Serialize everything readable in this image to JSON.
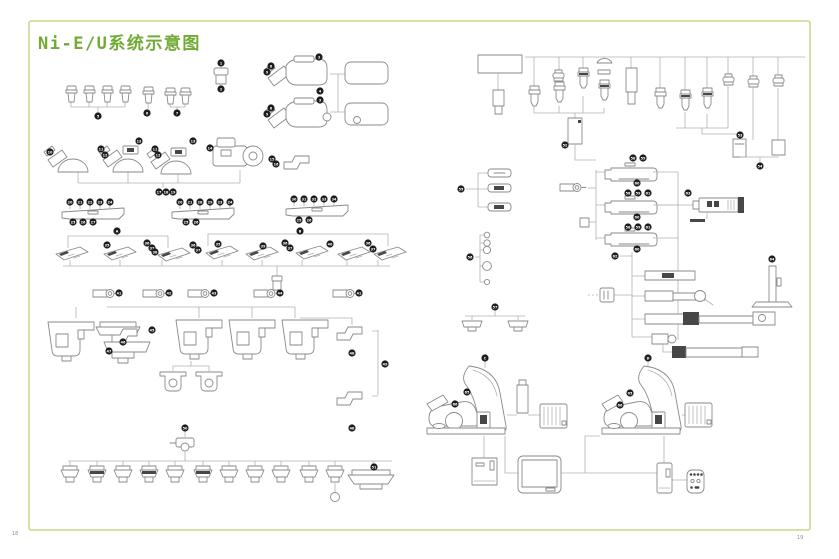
{
  "page": {
    "title": "Ni-E/U系统示意图",
    "page_number_left": "18",
    "page_number_right": "19"
  },
  "colors": {
    "title_green": "#72ab34",
    "border_green": "#cdde9d",
    "line_gray": "#b3b3b3",
    "part_gray": "#8a8a8a",
    "badge_black": "#1d1d1d"
  },
  "diagram": {
    "type": "exploded-system-diagram",
    "subject": "Nikon Ni-E/U upright microscope system configuration",
    "groups": [
      "eyepieces",
      "camera-heads",
      "observation-heads",
      "nosepiece-bars",
      "objective-turrets",
      "analyzer-sliders",
      "stages",
      "stage-clamps",
      "condensers",
      "objectives-tree",
      "filter-trays",
      "filter-circles",
      "lamp-sockets",
      "epi-illuminators",
      "lamphouse",
      "focus-column",
      "illumination-arms",
      "microscope-body-left",
      "microscope-body-right",
      "power-supply",
      "touch-monitor",
      "controller",
      "remote-control"
    ]
  },
  "badges": [
    {
      "x": 98,
      "y": 116,
      "t": "5"
    },
    {
      "x": 147,
      "y": 113,
      "t": "6"
    },
    {
      "x": 177,
      "y": 113,
      "t": "7"
    },
    {
      "x": 221,
      "y": 63,
      "t": "1"
    },
    {
      "x": 221,
      "y": 89,
      "t": "2"
    },
    {
      "x": 319,
      "y": 57,
      "t": "3"
    },
    {
      "x": 271,
      "y": 66,
      "t": "8"
    },
    {
      "x": 267,
      "y": 72,
      "t": "9"
    },
    {
      "x": 320,
      "y": 91,
      "t": "4"
    },
    {
      "x": 320,
      "y": 100,
      "t": "3"
    },
    {
      "x": 271,
      "y": 108,
      "t": "8"
    },
    {
      "x": 267,
      "y": 114,
      "t": "9"
    },
    {
      "x": 50,
      "y": 152,
      "t": "10"
    },
    {
      "x": 101,
      "y": 149,
      "t": "11"
    },
    {
      "x": 105,
      "y": 155,
      "t": "12"
    },
    {
      "x": 139,
      "y": 141,
      "t": "13"
    },
    {
      "x": 155,
      "y": 149,
      "t": "11"
    },
    {
      "x": 158,
      "y": 155,
      "t": "12"
    },
    {
      "x": 193,
      "y": 141,
      "t": "13"
    },
    {
      "x": 210,
      "y": 148,
      "t": "14"
    },
    {
      "x": 272,
      "y": 159,
      "t": "15"
    },
    {
      "x": 276,
      "y": 164,
      "t": "16"
    },
    {
      "x": 159,
      "y": 192,
      "t": "17"
    },
    {
      "x": 166,
      "y": 192,
      "t": "18"
    },
    {
      "x": 173,
      "y": 192,
      "t": "19"
    },
    {
      "x": 70,
      "y": 202,
      "t": "20"
    },
    {
      "x": 80,
      "y": 202,
      "t": "21"
    },
    {
      "x": 90,
      "y": 202,
      "t": "22"
    },
    {
      "x": 100,
      "y": 202,
      "t": "23"
    },
    {
      "x": 110,
      "y": 202,
      "t": "24"
    },
    {
      "x": 73,
      "y": 222,
      "t": "25"
    },
    {
      "x": 83,
      "y": 222,
      "t": "26"
    },
    {
      "x": 93,
      "y": 222,
      "t": "27"
    },
    {
      "x": 180,
      "y": 202,
      "t": "20"
    },
    {
      "x": 190,
      "y": 202,
      "t": "21"
    },
    {
      "x": 200,
      "y": 202,
      "t": "28"
    },
    {
      "x": 210,
      "y": 202,
      "t": "29"
    },
    {
      "x": 220,
      "y": 202,
      "t": "23"
    },
    {
      "x": 230,
      "y": 202,
      "t": "24"
    },
    {
      "x": 186,
      "y": 222,
      "t": "25"
    },
    {
      "x": 196,
      "y": 222,
      "t": "26"
    },
    {
      "x": 294,
      "y": 199,
      "t": "30"
    },
    {
      "x": 304,
      "y": 199,
      "t": "31"
    },
    {
      "x": 314,
      "y": 199,
      "t": "32"
    },
    {
      "x": 324,
      "y": 199,
      "t": "33"
    },
    {
      "x": 334,
      "y": 199,
      "t": "34"
    },
    {
      "x": 299,
      "y": 220,
      "t": "25"
    },
    {
      "x": 309,
      "y": 220,
      "t": "26"
    },
    {
      "x": 117,
      "y": 231,
      "t": "A"
    },
    {
      "x": 107,
      "y": 245,
      "t": "35"
    },
    {
      "x": 147,
      "y": 243,
      "t": "36"
    },
    {
      "x": 152,
      "y": 248,
      "t": "37"
    },
    {
      "x": 155,
      "y": 252,
      "t": "38"
    },
    {
      "x": 193,
      "y": 245,
      "t": "36"
    },
    {
      "x": 198,
      "y": 250,
      "t": "37"
    },
    {
      "x": 300,
      "y": 231,
      "t": "B"
    },
    {
      "x": 218,
      "y": 244,
      "t": "35"
    },
    {
      "x": 263,
      "y": 246,
      "t": "39"
    },
    {
      "x": 285,
      "y": 243,
      "t": "36"
    },
    {
      "x": 290,
      "y": 248,
      "t": "37"
    },
    {
      "x": 330,
      "y": 244,
      "t": "40"
    },
    {
      "x": 368,
      "y": 243,
      "t": "36"
    },
    {
      "x": 373,
      "y": 249,
      "t": "37"
    },
    {
      "x": 119,
      "y": 293,
      "t": "41"
    },
    {
      "x": 169,
      "y": 293,
      "t": "42"
    },
    {
      "x": 214,
      "y": 293,
      "t": "43"
    },
    {
      "x": 280,
      "y": 293,
      "t": "44"
    },
    {
      "x": 359,
      "y": 293,
      "t": "41"
    },
    {
      "x": 152,
      "y": 330,
      "t": "45"
    },
    {
      "x": 123,
      "y": 342,
      "t": "46"
    },
    {
      "x": 109,
      "y": 351,
      "t": "47"
    },
    {
      "x": 352,
      "y": 353,
      "t": "48"
    },
    {
      "x": 385,
      "y": 364,
      "t": "49"
    },
    {
      "x": 352,
      "y": 428,
      "t": "48"
    },
    {
      "x": 185,
      "y": 428,
      "t": "50"
    },
    {
      "x": 374,
      "y": 467,
      "t": "51"
    },
    {
      "x": 565,
      "y": 145,
      "t": "52"
    },
    {
      "x": 740,
      "y": 135,
      "t": "53"
    },
    {
      "x": 760,
      "y": 166,
      "t": "54"
    },
    {
      "x": 461,
      "y": 189,
      "t": "55"
    },
    {
      "x": 470,
      "y": 257,
      "t": "56"
    },
    {
      "x": 495,
      "y": 307,
      "t": "57"
    },
    {
      "x": 633,
      "y": 158,
      "t": "58"
    },
    {
      "x": 643,
      "y": 158,
      "t": "59"
    },
    {
      "x": 637,
      "y": 183,
      "t": "60"
    },
    {
      "x": 628,
      "y": 193,
      "t": "58"
    },
    {
      "x": 638,
      "y": 193,
      "t": "59"
    },
    {
      "x": 648,
      "y": 193,
      "t": "61"
    },
    {
      "x": 637,
      "y": 217,
      "t": "60"
    },
    {
      "x": 628,
      "y": 227,
      "t": "58"
    },
    {
      "x": 638,
      "y": 227,
      "t": "59"
    },
    {
      "x": 648,
      "y": 227,
      "t": "61"
    },
    {
      "x": 637,
      "y": 249,
      "t": "60"
    },
    {
      "x": 615,
      "y": 256,
      "t": "62"
    },
    {
      "x": 688,
      "y": 193,
      "t": "63"
    },
    {
      "x": 772,
      "y": 259,
      "t": "64"
    },
    {
      "x": 485,
      "y": 358,
      "t": "C"
    },
    {
      "x": 467,
      "y": 392,
      "t": "65"
    },
    {
      "x": 455,
      "y": 404,
      "t": "66"
    },
    {
      "x": 648,
      "y": 358,
      "t": "D"
    },
    {
      "x": 630,
      "y": 393,
      "t": "65"
    },
    {
      "x": 620,
      "y": 405,
      "t": "66"
    }
  ]
}
